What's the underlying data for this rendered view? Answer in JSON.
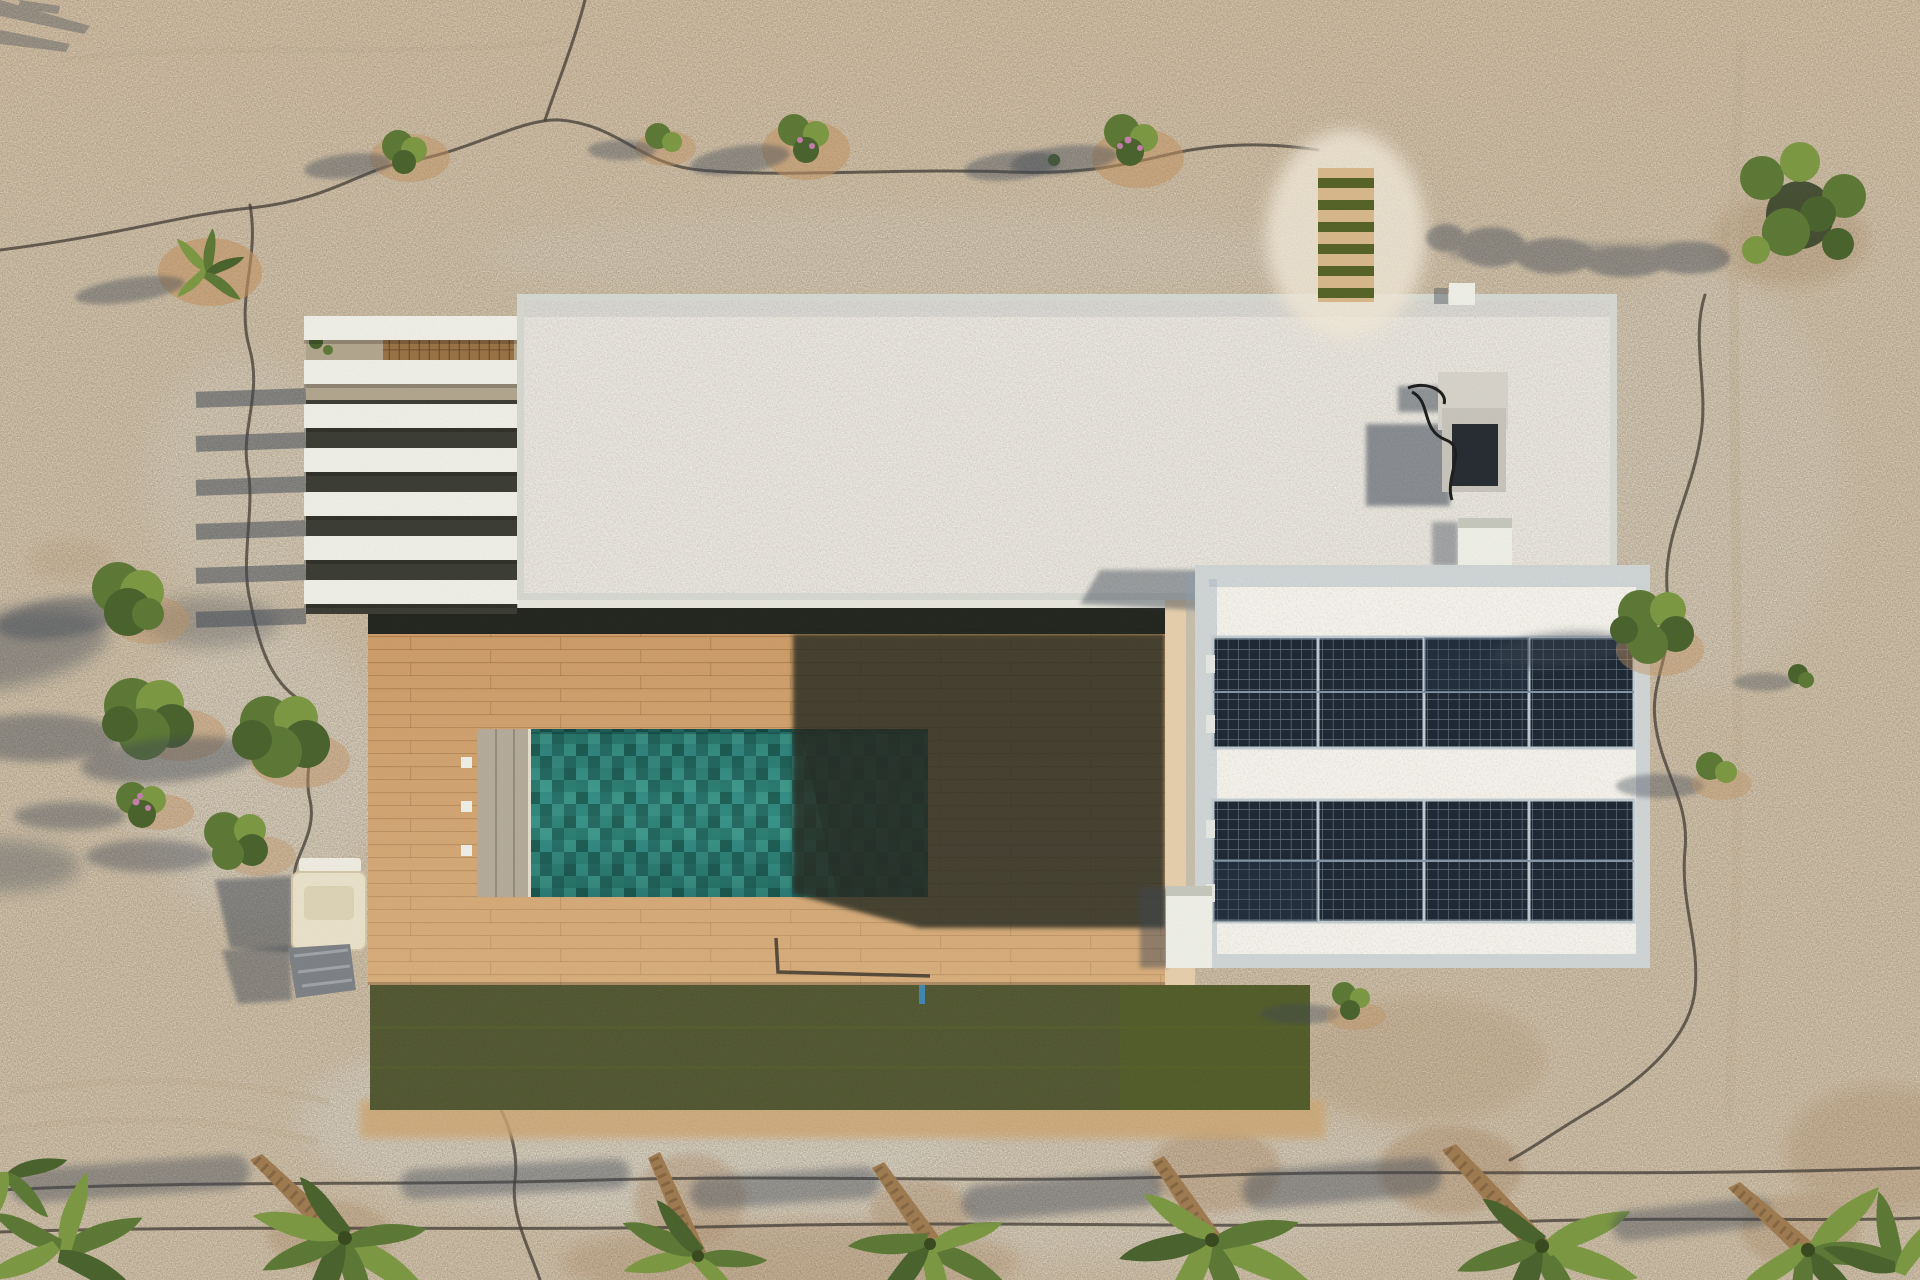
{
  "scene": {
    "type": "aerial-drone-photograph",
    "description": "Top-down aerial view of a modern flat-roof desert villa: white slatted pergola, pale gravel roof with AC unit and vents, attached roof wing with two rows of solar panels, wooden pool deck with turquoise mosaic pool partly in shadow, artificial grass strip, sandy ground with young palms, olive shrubs, irrigation hoses and long westward shadows.",
    "palette": {
      "sand": "#e8d1ae",
      "sandLight": "#f4ebda",
      "sandPink": "#eccfa4",
      "dirt": "#c49563",
      "gravel": "#e7e2d7",
      "roofEdge": "#d8dbd3",
      "fascia": "#ebeae1",
      "charcoal": "#22251e",
      "wood": "#cf9e69",
      "deckShadow": "#262a21",
      "poolBase": "#2b8178",
      "poolShadow": "#0b2e33",
      "poolStep": "#b6ad9b",
      "lawn": "#47551f",
      "soil": "#cfa873",
      "slat": "#f2f2ea",
      "wingWall": "#d2d7d8",
      "panel": "#1c2734",
      "panelLine": "#96abbc",
      "white": "#f1f2ea",
      "shadow": "#3d4654",
      "canopy": "#5d7a35",
      "canopyLight": "#7d9a43",
      "canopyDark": "#49632c",
      "trunk": "#a07c50",
      "hose": "#413b33",
      "sprinklerBlue": "#3f88b5"
    },
    "regions": [
      {
        "name": "sand-ground",
        "label": "Sandy desert ground"
      },
      {
        "name": "pergola",
        "label": "White slatted pergola"
      },
      {
        "name": "main-roof",
        "label": "Flat gravel roof"
      },
      {
        "name": "rooftop-ac-unit",
        "label": "Rooftop AC unit with shadow"
      },
      {
        "name": "roof-vent",
        "label": "Roof vent box"
      },
      {
        "name": "solar-wing",
        "label": "Roof wing with solar panels"
      },
      {
        "name": "solar-array-row-1",
        "label": "Upper solar panel row"
      },
      {
        "name": "solar-array-row-2",
        "label": "Lower solar panel row"
      },
      {
        "name": "wood-deck",
        "label": "Wooden pool deck"
      },
      {
        "name": "swimming-pool",
        "label": "Turquoise mosaic pool"
      },
      {
        "name": "pool-steps",
        "label": "Pool entry steps"
      },
      {
        "name": "lawn",
        "label": "Artificial grass strip"
      },
      {
        "name": "sprinkler",
        "label": "Blue lawn sprinkler"
      },
      {
        "name": "stepping-stone-path",
        "label": "Wood and grass stepping path"
      },
      {
        "name": "covered-vehicle",
        "label": "Covered cart and tarp"
      },
      {
        "name": "palm-trees",
        "label": "Young palms along irrigation line"
      },
      {
        "name": "olive-shrubs",
        "label": "Olive shrubs with long shadows"
      },
      {
        "name": "sculpted-tree",
        "label": "Sculpted tree, top right"
      },
      {
        "name": "irrigation-hoses",
        "label": "Black irrigation hoses"
      }
    ]
  }
}
